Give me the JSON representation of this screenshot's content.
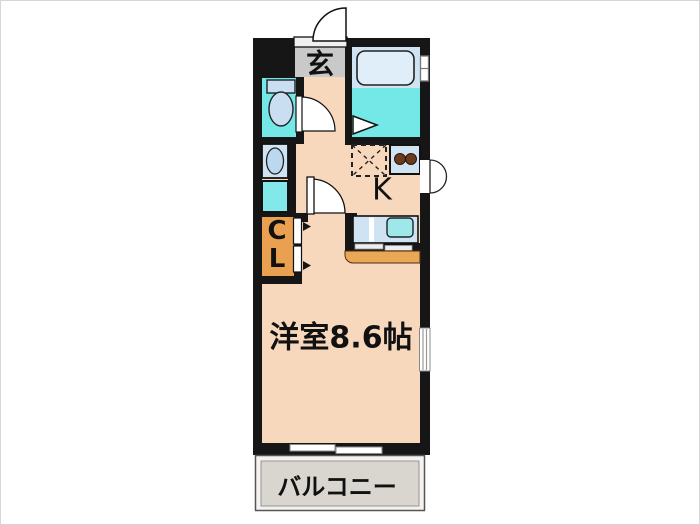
{
  "page": {
    "background": "#ffffff",
    "frame_border": "#d6d6d6"
  },
  "floorplan": {
    "type": "japanese-apartment-floorplan-1K",
    "labels": {
      "entrance": "玄",
      "kitchen": "K",
      "closet_line1": "C",
      "closet_line2": "L",
      "main_room": "洋室8.6帖",
      "balcony": "バルコニー"
    },
    "fixtures": [
      "entrance-door-arc",
      "bathtub",
      "bath-window",
      "bathroom-folding-door",
      "toilet",
      "toilet-door-arc",
      "washbasin",
      "washing-machine-space",
      "refrigerator-space-dashed",
      "stove-2-burner",
      "kitchen-sink-counter",
      "kitchen-service-door",
      "counter-table",
      "room-door-arc",
      "closet-double-doors",
      "room-window",
      "balcony-sliding-window"
    ],
    "colors": {
      "wall": "#161616",
      "floor_peach": "#f8d8bc",
      "wet_area_cyan": "#74e7e7",
      "fixture_blue": "#cfe3f3",
      "fixture_light_blue": "#dfeef9",
      "closet_orange": "#e9a050",
      "counter_orange": "#eaa755",
      "genkan_gray": "#c9c9c9",
      "balcony_gray": "#d9d5cf",
      "burner_brown": "#6b3a1f"
    }
  }
}
